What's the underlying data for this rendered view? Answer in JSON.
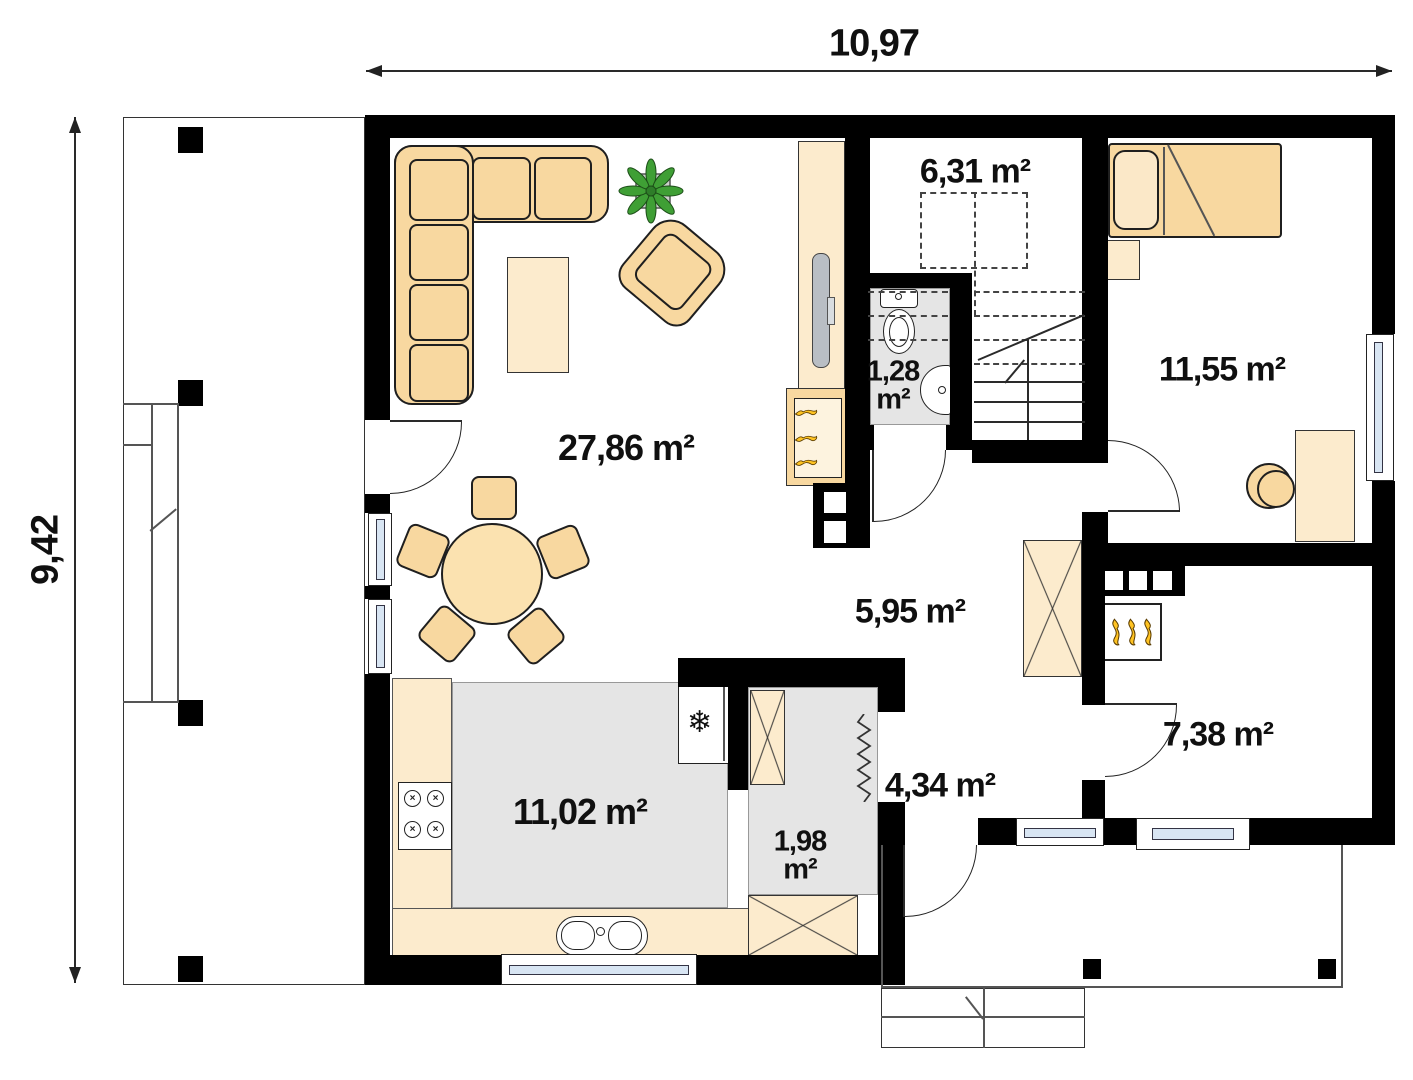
{
  "plan": {
    "dimensions": {
      "width": "10,97",
      "height": "9,42"
    },
    "rooms": {
      "living_room": {
        "area": "27,86 m²"
      },
      "kitchen": {
        "area": "11,02 m²"
      },
      "staircase": {
        "area": "6,31 m²"
      },
      "hall": {
        "area": "5,95 m²"
      },
      "vestibule": {
        "area": "4,34 m²"
      },
      "bedroom": {
        "area": "11,55 m²"
      },
      "utility_room": {
        "area": "7,38 m²"
      },
      "wc": {
        "area_value": "1,28",
        "area_unit": "m²"
      },
      "pantry": {
        "area_value": "1,98",
        "area_unit": "m²"
      }
    },
    "glyphs": {
      "snowflake": "❄",
      "burner": "×"
    },
    "colors": {
      "wall": "#000000",
      "furniture": "#f8d8a0",
      "surface": "#fcebcd",
      "floor_gray": "#e5e5e5",
      "window_glass": "#d8e5f3",
      "plant_green": "#3f9f35",
      "flame_yellow": "#ffc322"
    }
  }
}
